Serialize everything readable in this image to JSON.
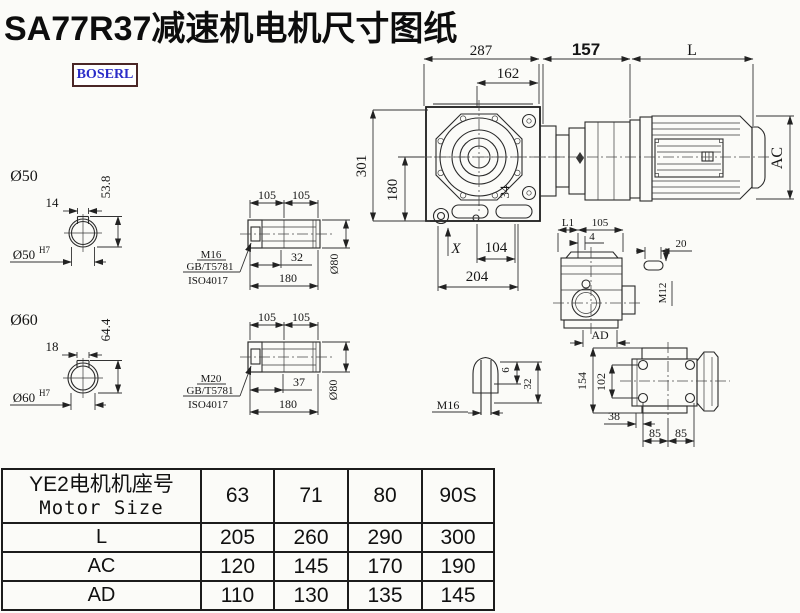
{
  "title": "SA77R37减速机电机尺寸图纸",
  "logo": "BOSERL",
  "colors": {
    "logo_text": "#2a2cc8",
    "logo_border": "#4a2626",
    "line": "#1c1c1c",
    "background": "#fbfbf8"
  },
  "main_view": {
    "d287": "287",
    "d162": "162",
    "d157": "157",
    "dL": "L",
    "dAC": "AC",
    "d301": "301",
    "d180": "180",
    "dX": "X",
    "d104": "104",
    "d204": "204",
    "d34": "34"
  },
  "shaft50": {
    "label": "Ø50",
    "key_width": "14",
    "key_height": "53.8",
    "bore": "Ø50",
    "tol": "H7"
  },
  "shaft60": {
    "label": "Ø60",
    "key_width": "18",
    "key_height": "64.4",
    "bore": "Ø60",
    "tol": "H7"
  },
  "hollow50": {
    "l1": "105",
    "l2": "105",
    "thread": "M16",
    "std1": "GB/T5781",
    "std2": "ISO4017",
    "depth": "32",
    "len": "180",
    "dia": "Ø80"
  },
  "hollow60": {
    "l1": "105",
    "l2": "105",
    "thread": "M20",
    "std1": "GB/T5781",
    "std2": "ISO4017",
    "depth": "37",
    "len": "180",
    "dia": "Ø80"
  },
  "plug": {
    "thread": "M16",
    "d6": "6",
    "d32": "32"
  },
  "side_view": {
    "dL1": "L1",
    "d105": "105",
    "d4": "4",
    "dAD": "AD",
    "d20": "20",
    "thread": "M12"
  },
  "rear_view": {
    "d154": "154",
    "d102": "102",
    "d38": "38",
    "d85a": "85",
    "d85b": "85"
  },
  "table": {
    "header_cn": "YE2电机机座号",
    "header_en": "Motor Size",
    "columns": [
      "63",
      "71",
      "80",
      "90S"
    ],
    "rows": [
      {
        "label": "L",
        "values": [
          "205",
          "260",
          "290",
          "300"
        ]
      },
      {
        "label": "AC",
        "values": [
          "120",
          "145",
          "170",
          "190"
        ]
      },
      {
        "label": "AD",
        "values": [
          "110",
          "130",
          "135",
          "145"
        ]
      }
    ]
  }
}
